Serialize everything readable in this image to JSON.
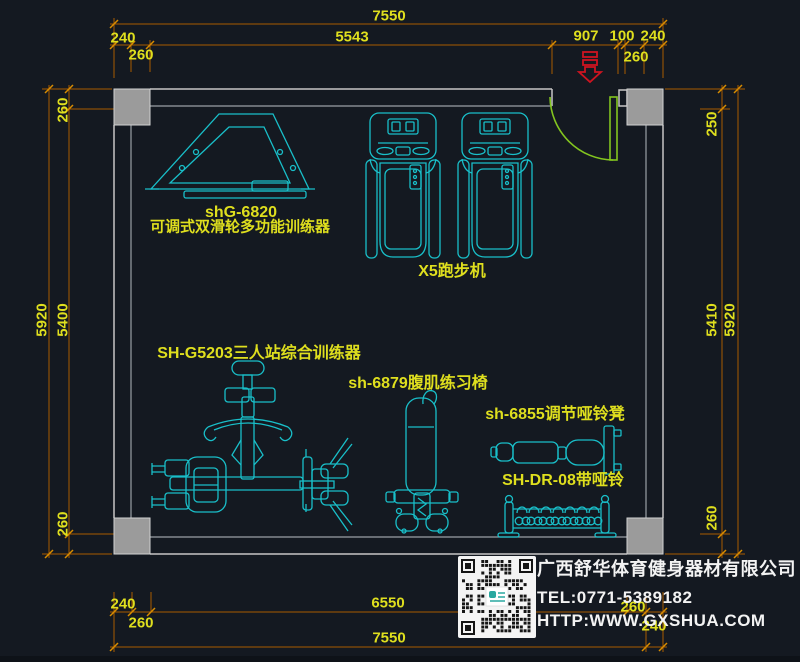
{
  "colors": {
    "background": "#141921",
    "dim_line": "#A85A00",
    "dim_tick": "#D88C00",
    "dim_text": "#DFDF1E",
    "equipment": "#19BFC9",
    "wall": "#C6C6C6",
    "column": "#9B9B9B",
    "door": "#83C51F",
    "entry": "#CE1420",
    "company_text": "#F3F3F3",
    "qr_bg": "#F4F4F4"
  },
  "dims": {
    "top_total": "7550",
    "top_wall_left": "240",
    "top_5543": "5543",
    "top_907": "907",
    "top_100": "100",
    "top_wall_right": "240",
    "top_col_left": "260",
    "top_col_right": "260",
    "left_total": "5920",
    "left_inner": "5400",
    "left_col_top": "260",
    "left_col_bottom": "260",
    "right_top": "250",
    "right_inner": "5410",
    "right_total": "5920",
    "right_col_bottom": "260",
    "bottom_wall_left": "240",
    "bottom_col_left": "260",
    "bottom_inner": "6550",
    "bottom_col_right": "260",
    "bottom_wall_right": "240",
    "bottom_total": "7550"
  },
  "equipment": {
    "trainer_model": "shG-6820",
    "trainer_name": "可调式双滑轮多功能训练器",
    "treadmill": "X5跑步机",
    "station": "SH-G5203三人站综合训练器",
    "ab_bench": "sh-6879腹肌练习椅",
    "dumbbell_bench": "sh-6855调节哑铃凳",
    "dumbbell_rack": "SH-DR-08带哑铃"
  },
  "company": {
    "name": "广西舒华体育健身器材有限公司",
    "tel": "TEL:0771-5389182",
    "website": "HTTP:WWW.GXSHUA.COM"
  }
}
